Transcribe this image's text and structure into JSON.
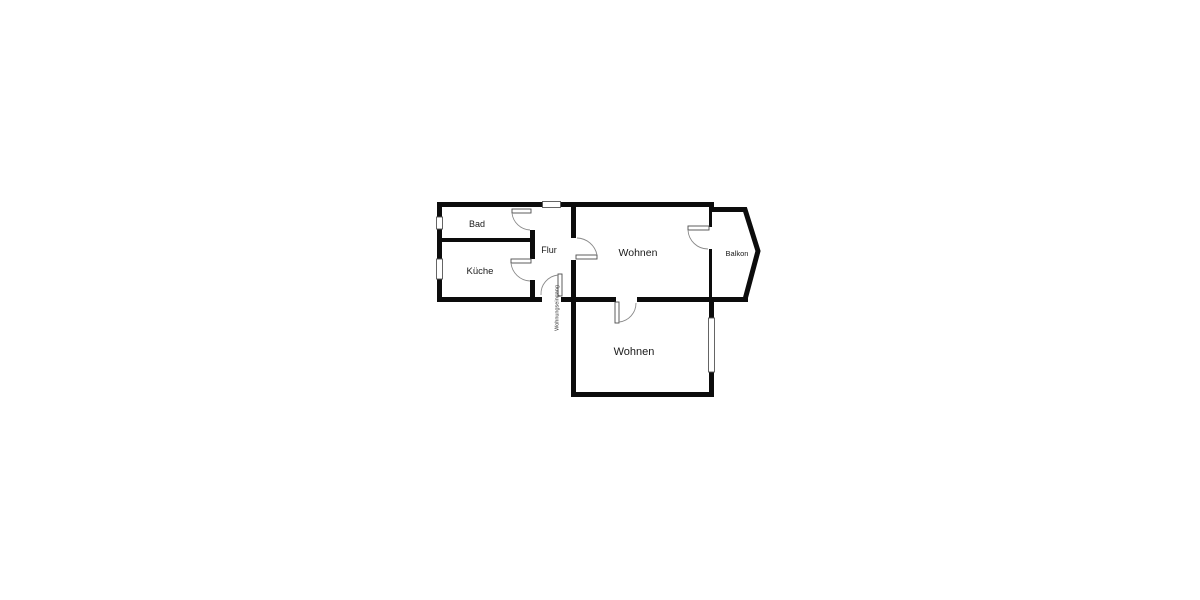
{
  "page": {
    "background": "#ffffff",
    "kind": "apartment-floor-plan"
  },
  "floor_plan": {
    "rooms": [
      {
        "name": "bad",
        "label": "Bad"
      },
      {
        "name": "kueche",
        "label": "Küche"
      },
      {
        "name": "flur",
        "label": "Flur"
      },
      {
        "name": "wohnen-top",
        "label": "Wohnen"
      },
      {
        "name": "balkon",
        "label": "Balkon"
      },
      {
        "name": "wohnen-bottom",
        "label": "Wohnen"
      }
    ],
    "annotations": {
      "entrance": "Wohnungseingang"
    },
    "colors": {
      "wall": "#0c0c0c",
      "door_leaf": "#4d4d4d",
      "door_arc": "#8a8a8a",
      "window_frame": "#555555",
      "text": "#1a1a1a",
      "background": "#ffffff"
    }
  }
}
